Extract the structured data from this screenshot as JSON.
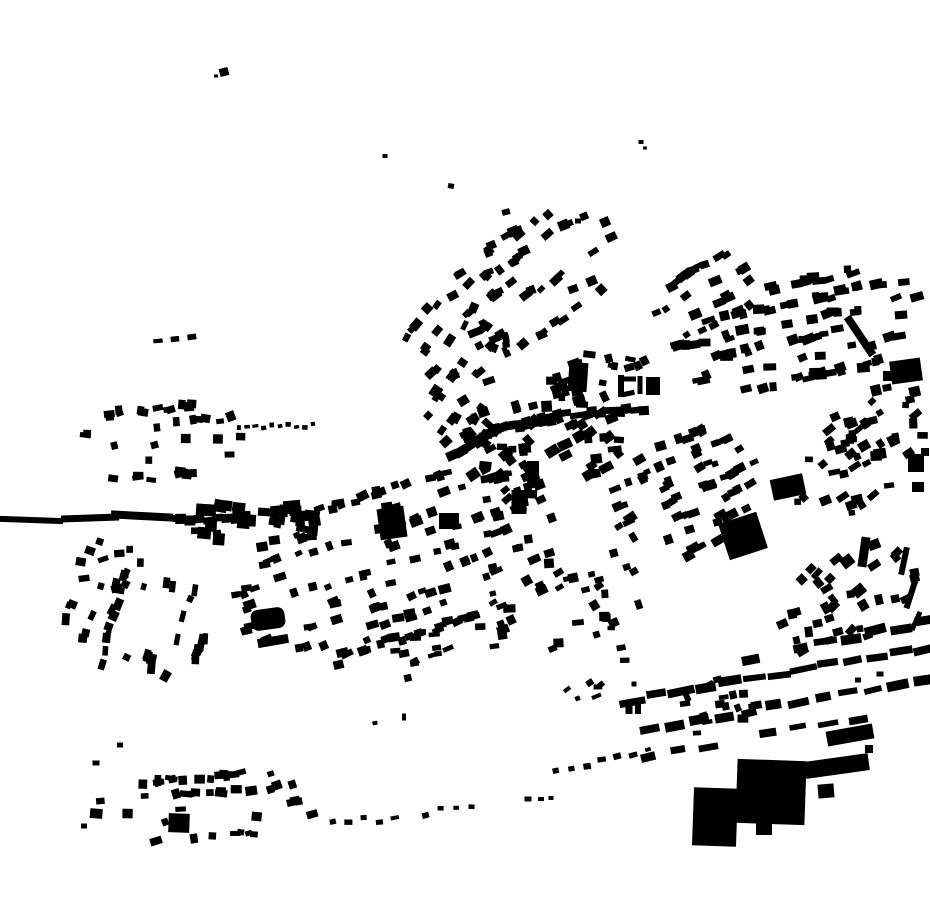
{
  "page": {
    "title": "Building footprint figure-ground map"
  },
  "map": {
    "width": 930,
    "height": 924,
    "background": "#ffffff",
    "building_color": "#000000",
    "seed": 42,
    "singles": [
      [
        224,
        72,
        9,
        8,
        -15
      ],
      [
        216,
        76,
        4,
        3,
        0
      ],
      [
        385,
        156,
        5,
        4,
        0
      ],
      [
        451,
        186,
        6,
        5,
        10
      ],
      [
        506,
        212,
        8,
        6,
        -15
      ],
      [
        641,
        142,
        5,
        4,
        0
      ],
      [
        645,
        148,
        4,
        3,
        0
      ],
      [
        578,
        221,
        6,
        5,
        0
      ],
      [
        578,
        377,
        19,
        29,
        4
      ],
      [
        533,
        474,
        12,
        26,
        0
      ],
      [
        621,
        386,
        6,
        22,
        0
      ],
      [
        630,
        379,
        12,
        5,
        0
      ],
      [
        640,
        385,
        5,
        18,
        0
      ],
      [
        653,
        386,
        14,
        18,
        0
      ],
      [
        392,
        523,
        27,
        31,
        -8
      ],
      [
        519,
        502,
        15,
        24,
        0
      ],
      [
        449,
        521,
        20,
        16,
        0
      ],
      [
        273,
        641,
        31,
        9,
        -10
      ],
      [
        179,
        823,
        21,
        19,
        2
      ],
      [
        906,
        371,
        31,
        23,
        -8
      ],
      [
        888,
        376,
        10,
        10,
        0
      ],
      [
        860,
        336,
        8,
        46,
        -34
      ],
      [
        743,
        536,
        40,
        38,
        -18
      ],
      [
        788,
        487,
        33,
        21,
        -12
      ],
      [
        715,
        817,
        44,
        58,
        2
      ],
      [
        771,
        792,
        69,
        64,
        2
      ],
      [
        764,
        829,
        16,
        12,
        0
      ],
      [
        837,
        766,
        64,
        17,
        -8
      ],
      [
        850,
        735,
        47,
        15,
        -10
      ],
      [
        826,
        791,
        16,
        14,
        -5
      ],
      [
        869,
        749,
        8,
        8,
        0
      ],
      [
        904,
        561,
        6,
        28,
        12
      ],
      [
        911,
        594,
        6,
        30,
        18
      ],
      [
        916,
        621,
        5,
        20,
        24
      ],
      [
        864,
        552,
        9,
        30,
        8
      ],
      [
        916,
        463,
        16,
        18,
        0
      ],
      [
        918,
        487,
        12,
        10,
        0
      ],
      [
        925,
        452,
        8,
        8,
        0
      ],
      [
        629,
        707,
        7,
        14,
        0
      ],
      [
        638,
        707,
        6,
        14,
        0
      ],
      [
        375,
        723,
        5,
        4,
        -10
      ],
      [
        404,
        717,
        4,
        7,
        0
      ],
      [
        634,
        684,
        5,
        5,
        0
      ],
      [
        528,
        799,
        7,
        5,
        0
      ],
      [
        541,
        799,
        6,
        4,
        0
      ],
      [
        551,
        798,
        5,
        4,
        0
      ],
      [
        84,
        826,
        6,
        5,
        0
      ],
      [
        96,
        763,
        7,
        5,
        0
      ],
      [
        120,
        745,
        6,
        5,
        0
      ],
      [
        858,
        680,
        6,
        5,
        0
      ],
      [
        880,
        674,
        7,
        5,
        0
      ],
      [
        206,
        510,
        20,
        12,
        4
      ],
      [
        292,
        507,
        17,
        13,
        -5
      ],
      [
        312,
        516,
        15,
        11,
        8
      ],
      [
        31,
        520,
        64,
        6,
        2
      ],
      [
        90,
        518,
        58,
        7,
        -2
      ],
      [
        142,
        516,
        62,
        8,
        3
      ]
    ],
    "rounded": [
      [
        268,
        619,
        34,
        21,
        -8,
        7
      ]
    ],
    "strips": [
      {
        "f": [
          458,
          456
        ],
        "t": [
          492,
          432
        ],
        "n": 4,
        "w": 10,
        "h": 10,
        "touch": 1,
        "jr": 8
      },
      {
        "f": [
          492,
          431
        ],
        "t": [
          562,
          415
        ],
        "n": 9,
        "w": 9,
        "h": 11,
        "touch": 1,
        "jr": 7
      },
      {
        "f": [
          562,
          415
        ],
        "t": [
          648,
          408
        ],
        "n": 10,
        "w": 9,
        "h": 8,
        "touch": 1,
        "jr": 6
      },
      {
        "f": [
          502,
          334
        ],
        "t": [
          508,
          356
        ],
        "n": 5,
        "w": 7,
        "h": 6,
        "touch": 1,
        "jr": 10
      },
      {
        "f": [
          176,
          520
        ],
        "t": [
          250,
          516
        ],
        "n": 8,
        "w": 10,
        "h": 9,
        "touch": 1,
        "jr": 4
      },
      {
        "f": [
          239,
          429
        ],
        "t": [
          313,
          425
        ],
        "n": 10,
        "w": 5,
        "h": 4,
        "jr": 8
      },
      {
        "f": [
          158,
          341
        ],
        "t": [
          192,
          338
        ],
        "n": 3,
        "w": 8,
        "h": 5,
        "jr": 5
      },
      {
        "f": [
          700,
          668
        ],
        "t": [
          926,
          622
        ],
        "n": 10,
        "w": 19,
        "h": 8,
        "jr": 4,
        "skip": 0.12
      },
      {
        "f": [
          632,
          700
        ],
        "t": [
          926,
          648
        ],
        "n": 13,
        "w": 22,
        "h": 8,
        "jr": 4
      },
      {
        "f": [
          650,
          731
        ],
        "t": [
          922,
          678
        ],
        "n": 12,
        "w": 20,
        "h": 8,
        "jr": 4,
        "skip": 0.08
      },
      {
        "f": [
          618,
          762
        ],
        "t": [
          888,
          712
        ],
        "n": 10,
        "w": 17,
        "h": 7,
        "jr": 5,
        "skip": 0.2
      },
      {
        "f": [
          556,
          772
        ],
        "t": [
          648,
          750
        ],
        "n": 7,
        "w": 7,
        "h": 5,
        "jr": 8
      },
      {
        "f": [
          333,
          824
        ],
        "t": [
          472,
          812
        ],
        "n": 10,
        "w": 7,
        "h": 5,
        "jr": 12,
        "jo": 7,
        "skip": 0.1
      }
    ],
    "clusters": [
      {
        "cx": 530,
        "cy": 282,
        "rx": 100,
        "ry": 58,
        "a": -33,
        "n": 55,
        "w": 9,
        "h": 7,
        "rs": 21,
        "jr": 14
      },
      {
        "cx": 452,
        "cy": 342,
        "rx": 48,
        "ry": 46,
        "a": -55,
        "n": 20,
        "w": 9,
        "h": 7,
        "rs": 19,
        "jr": 14
      },
      {
        "cx": 800,
        "cy": 330,
        "rx": 128,
        "ry": 56,
        "a": -12,
        "n": 100,
        "w": 10,
        "h": 7,
        "rs": 19,
        "jr": 12
      },
      {
        "cx": 706,
        "cy": 296,
        "rx": 58,
        "ry": 36,
        "a": -28,
        "n": 26,
        "w": 9,
        "h": 7,
        "rs": 18,
        "jr": 12
      },
      {
        "cx": 882,
        "cy": 424,
        "rx": 48,
        "ry": 46,
        "a": -20,
        "n": 26,
        "w": 9,
        "h": 8,
        "rs": 0,
        "jr": 25
      },
      {
        "cx": 540,
        "cy": 444,
        "rx": 92,
        "ry": 54,
        "a": -18,
        "n": 62,
        "w": 10,
        "h": 8,
        "rs": 0,
        "jr": 25
      },
      {
        "cx": 596,
        "cy": 378,
        "rx": 55,
        "ry": 26,
        "a": -8,
        "n": 20,
        "w": 9,
        "h": 7,
        "rs": 0,
        "jr": 20
      },
      {
        "cx": 462,
        "cy": 408,
        "rx": 40,
        "ry": 46,
        "a": -40,
        "n": 24,
        "w": 9,
        "h": 8,
        "rs": 0,
        "jr": 22
      },
      {
        "cx": 162,
        "cy": 442,
        "rx": 82,
        "ry": 42,
        "a": -6,
        "n": 38,
        "w": 9,
        "h": 7,
        "rs": 17,
        "jr": 16
      },
      {
        "cx": 252,
        "cy": 522,
        "rx": 85,
        "ry": 20,
        "a": 2,
        "n": 34,
        "w": 10,
        "h": 9,
        "rs": 0,
        "jr": 10
      },
      {
        "cx": 136,
        "cy": 622,
        "rx": 58,
        "ry": 80,
        "a": -75,
        "n": 38,
        "w": 9,
        "h": 7,
        "rs": 22,
        "jr": 15
      },
      {
        "cx": 400,
        "cy": 562,
        "rx": 175,
        "ry": 82,
        "a": -17,
        "n": 150,
        "w": 9,
        "h": 7,
        "rs": 19,
        "jr": 10
      },
      {
        "cx": 560,
        "cy": 602,
        "rx": 88,
        "ry": 48,
        "a": -17,
        "n": 32,
        "w": 9,
        "h": 7,
        "rs": 0,
        "jr": 18
      },
      {
        "cx": 692,
        "cy": 492,
        "rx": 85,
        "ry": 62,
        "a": -25,
        "n": 80,
        "w": 9,
        "h": 7,
        "rs": 17,
        "jr": 10
      },
      {
        "cx": 840,
        "cy": 470,
        "rx": 55,
        "ry": 48,
        "a": -20,
        "n": 28,
        "w": 9,
        "h": 7,
        "rs": 0,
        "jr": 22
      },
      {
        "cx": 848,
        "cy": 598,
        "rx": 78,
        "ry": 48,
        "a": -28,
        "n": 36,
        "w": 9,
        "h": 8,
        "rs": 0,
        "jr": 22
      },
      {
        "cx": 715,
        "cy": 706,
        "rx": 45,
        "ry": 26,
        "a": -15,
        "n": 16,
        "w": 8,
        "h": 6,
        "rs": 0,
        "jr": 15
      },
      {
        "cx": 210,
        "cy": 806,
        "rx": 118,
        "ry": 36,
        "a": -4,
        "n": 46,
        "w": 9,
        "h": 7,
        "rs": 15,
        "jr": 16
      },
      {
        "cx": 592,
        "cy": 664,
        "rx": 45,
        "ry": 38,
        "a": -20,
        "n": 10,
        "w": 7,
        "h": 5,
        "rs": 0,
        "jr": 20
      },
      {
        "cx": 108,
        "cy": 572,
        "rx": 34,
        "ry": 32,
        "a": 0,
        "n": 12,
        "w": 8,
        "h": 6,
        "rs": 0,
        "jr": 20
      },
      {
        "cx": 390,
        "cy": 660,
        "rx": 60,
        "ry": 30,
        "a": -15,
        "n": 14,
        "w": 8,
        "h": 6,
        "rs": 0,
        "jr": 15
      }
    ]
  }
}
